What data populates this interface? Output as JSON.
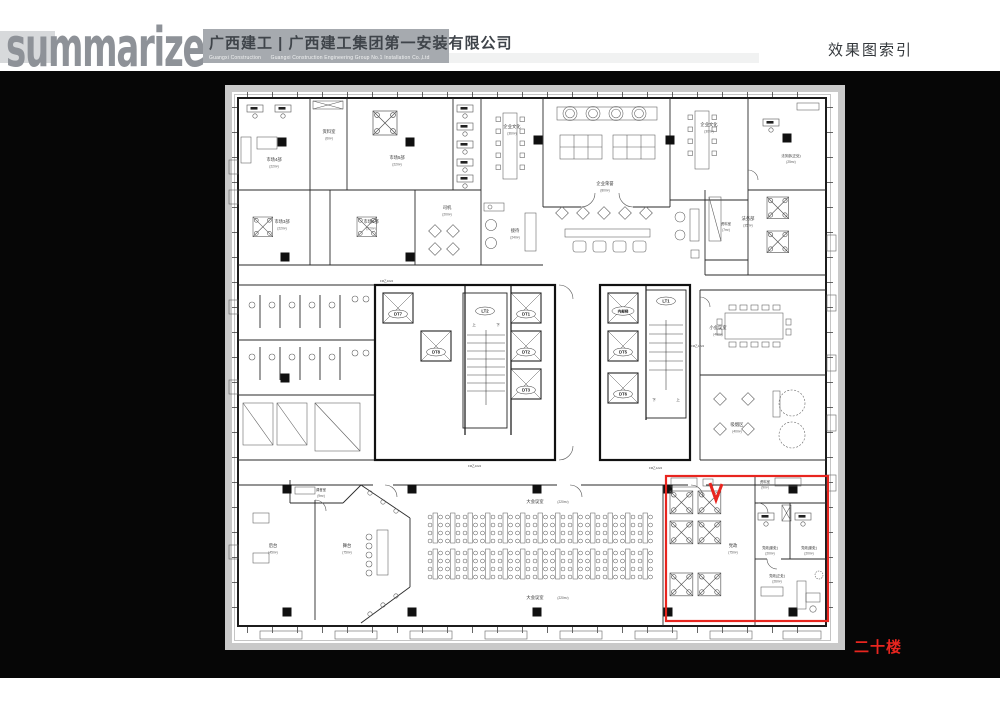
{
  "header": {
    "logo": "summarize",
    "company_cn": "广西建工 | 广西建工集团第一安装有限公司",
    "company_en": "Guangxi Construction      Guangxi Construction Engineering Group No.1 Installation Co.,Ltd",
    "page_title": "效果图索引"
  },
  "floor_label": "二十楼",
  "colors": {
    "accent_red": "#e8251f",
    "header_gray": "#a6aaaf",
    "logo_gray": "#8e9298"
  },
  "plan": {
    "rooms": {
      "shichang4": {
        "label": "市场4部",
        "area": "(22m²)"
      },
      "ziliao1": {
        "label": "资料室",
        "area": "(6m²)"
      },
      "shichang5": {
        "label": "市场5部",
        "area": "(22m²)"
      },
      "shichang3": {
        "label": "市场3部",
        "area": "(22m²)"
      },
      "shichang6": {
        "label": "市场6部",
        "area": "(22m²)"
      },
      "siji": {
        "label": "司机",
        "area": "(20m²)"
      },
      "qywh_left": {
        "label": "企业文化",
        "area": "(36m²)"
      },
      "qyry": {
        "label": "企业荣誉",
        "area": "(80m²)"
      },
      "qywh_right": {
        "label": "企业文化",
        "area": "(30m²)"
      },
      "jiedai": {
        "label": "接待",
        "area": "(24m²)"
      },
      "fawu_zheng": {
        "label": "法务部(正处)",
        "area": "(25m²)"
      },
      "fawu": {
        "label": "法务部",
        "area": "(35m²)"
      },
      "ziliao2": {
        "label": "资料室",
        "area": "(7m²)"
      },
      "xiaohys": {
        "label": "小会议室",
        "area": "(40m²)"
      },
      "xiyan": {
        "label": "吸烟区",
        "area": "(40m²)"
      },
      "tiaoyin": {
        "label": "调音室",
        "area": "(9m²)"
      },
      "houtai": {
        "label": "后台",
        "area": "(45m²)"
      },
      "wutai": {
        "label": "舞台",
        "area": "(75m²)"
      },
      "dahys": {
        "label": "大会议室",
        "area": "(220m²)"
      },
      "dangzheng": {
        "label": "党政",
        "area": "(75m²)"
      },
      "ziliao3": {
        "label": "资料室",
        "area": "(9m²)"
      },
      "dz_fu": {
        "label": "党政(副处)",
        "area": "(20m²)"
      },
      "dz_fu2": {
        "label": "党政(副处)",
        "area": "(20m²)"
      },
      "dz_zheng": {
        "label": "党政(正处)",
        "area": "(26m²)"
      }
    },
    "lifts": {
      "dt1": "DT1",
      "dt2": "DT2",
      "dt3": "DT3",
      "dt5": "DT5",
      "dt6": "DT6",
      "dt7": "DT7",
      "dt8": "DT8",
      "lt1": "LT1",
      "lt2": "LT2",
      "neibuti": "内部梯"
    },
    "stairs": {
      "up": "上",
      "down": "下"
    },
    "door_labels": {
      "fm1024": "FM乙1024",
      "fm1224": "FM乙1224"
    }
  }
}
